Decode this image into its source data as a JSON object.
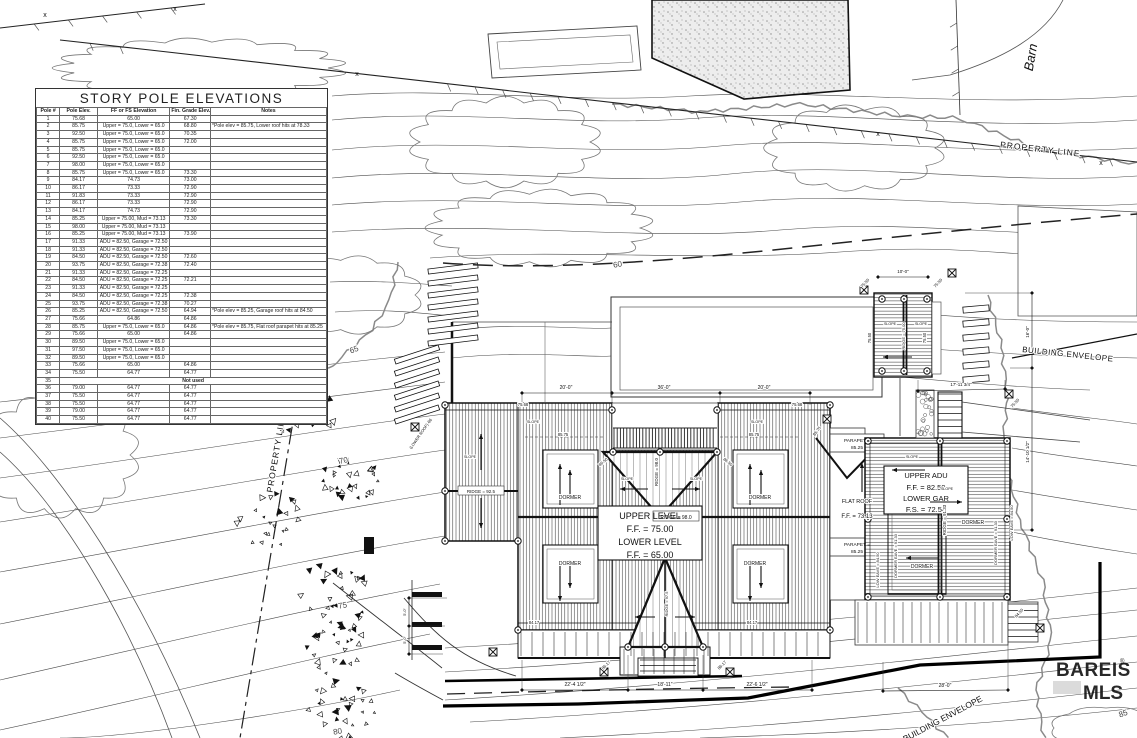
{
  "story_pole_table": {
    "title": "STORY POLE ELEVATIONS",
    "headers": [
      "Pole #",
      "Pole Elev.",
      "FF or FS Elevation",
      "Fin. Grade Elev.",
      "Notes"
    ],
    "rows": [
      [
        "1",
        "75.68",
        "65.00",
        "67.30",
        ""
      ],
      [
        "2",
        "85.75",
        "Upper = 75.0, Lower = 65.0",
        "68.80",
        "*Pole elev = 85.75, Lower roof hits at 78.33"
      ],
      [
        "3",
        "92.50",
        "Upper = 75.0, Lower = 65.0",
        "70.35",
        ""
      ],
      [
        "4",
        "85.75",
        "Upper = 75.0, Lower = 65.0",
        "72.00",
        ""
      ],
      [
        "5",
        "85.75",
        "Upper = 75.0, Lower = 65.0",
        "",
        ""
      ],
      [
        "6",
        "92.50",
        "Upper = 75.0, Lower = 65.0",
        "",
        ""
      ],
      [
        "7",
        "98.00",
        "Upper = 75.0, Lower = 65.0",
        "",
        ""
      ],
      [
        "8",
        "85.75",
        "Upper = 75.0, Lower = 65.0",
        "73.30",
        ""
      ],
      [
        "9",
        "84.17",
        "74.73",
        "73.00",
        ""
      ],
      [
        "10",
        "86.17",
        "73.33",
        "72.90",
        ""
      ],
      [
        "11",
        "91.83",
        "73.33",
        "72.90",
        ""
      ],
      [
        "12",
        "86.17",
        "73.33",
        "72.90",
        ""
      ],
      [
        "13",
        "84.17",
        "74.73",
        "72.90",
        ""
      ],
      [
        "14",
        "85.25",
        "Upper = 75.00, Mud = 73.13",
        "73.30",
        ""
      ],
      [
        "15",
        "98.00",
        "Upper = 75.00, Mud = 73.13",
        "",
        ""
      ],
      [
        "16",
        "85.25",
        "Upper = 75.00, Mud = 73.13",
        "73.90",
        ""
      ],
      [
        "17",
        "91.33",
        "ADU = 82.50, Garage = 72.50",
        "",
        ""
      ],
      [
        "18",
        "91.33",
        "ADU = 82.50, Garage = 72.50",
        "",
        ""
      ],
      [
        "19",
        "84.50",
        "ADU = 82.50, Garage = 72.50",
        "72.60",
        ""
      ],
      [
        "20",
        "93.75",
        "ADU = 82.50, Garage = 72.38",
        "72.40",
        ""
      ],
      [
        "21",
        "91.33",
        "ADU = 82.50, Garage = 72.25",
        "",
        ""
      ],
      [
        "22",
        "84.50",
        "ADU = 82.50, Garage = 72.25",
        "72.21",
        ""
      ],
      [
        "23",
        "91.33",
        "ADU = 82.50, Garage = 72.25",
        "",
        ""
      ],
      [
        "24",
        "84.50",
        "ADU = 82.50, Garage = 72.25",
        "72.38",
        ""
      ],
      [
        "25",
        "93.75",
        "ADU = 82.50, Garage = 72.38",
        "70.27",
        ""
      ],
      [
        "26",
        "85.25",
        "ADU = 82.50, Garage = 72.50",
        "64.94",
        "*Pole elev = 85.25, Garage roof hits at 84.50"
      ],
      [
        "27",
        "75.66",
        "64.86",
        "64.86",
        ""
      ],
      [
        "28",
        "85.75",
        "Upper = 75.0, Lower = 65.0",
        "64.86",
        "*Pole elev = 85.75, Flat roof parapet hits at 85.25"
      ],
      [
        "29",
        "75.66",
        "65.00",
        "64.86",
        ""
      ],
      [
        "30",
        "89.50",
        "Upper = 75.0, Lower = 65.0",
        "",
        ""
      ],
      [
        "31",
        "97.50",
        "Upper = 75.0, Lower = 65.0",
        "",
        ""
      ],
      [
        "32",
        "89.50",
        "Upper = 75.0, Lower = 65.0",
        "",
        ""
      ],
      [
        "33",
        "75.66",
        "65.00",
        "64.86",
        ""
      ],
      [
        "34",
        "75.50",
        "64.77",
        "64.77",
        ""
      ],
      [
        "35",
        "Not used"
      ],
      [
        "36",
        "79.00",
        "64.77",
        "64.77",
        ""
      ],
      [
        "37",
        "75.50",
        "64.77",
        "64.77",
        ""
      ],
      [
        "38",
        "75.50",
        "64.77",
        "64.77",
        ""
      ],
      [
        "39",
        "79.00",
        "64.77",
        "64.77",
        ""
      ],
      [
        "40",
        "75.50",
        "64.77",
        "64.77",
        ""
      ]
    ]
  },
  "labels": {
    "barn": "Barn",
    "property_line_top": "PROPERTY LINE",
    "property_line_left": "PROPERTY LINE",
    "building_envelope_right": "BUILDING ENVELOPE",
    "building_envelope_bottom": "BUILDING ENVELOPE",
    "contour_60": "60",
    "contour_65": "65",
    "contour_70": "70",
    "contour_75": "75",
    "contour_80": "80",
    "contour_85": "85",
    "upper_level": "UPPER LEVEL",
    "upper_level_ff": "F.F. = 75.00",
    "lower_level": "LOWER LEVEL",
    "lower_level_ff": "F.F. = 65.00",
    "upper_adu": "UPPER ADU",
    "upper_adu_ff": "F.F. = 82.50",
    "lower_gar": "LOWER GAR",
    "lower_gar_fs": "F.S. = 72.50",
    "flat_roof": "FLAT ROOF",
    "flat_roof_ff": "F.F. = 73.13",
    "parapet_line1": "PARAPET =",
    "parapet_line2": "85.25",
    "ridge_main": "RIDGE = 98.0",
    "ridge_left_wing": "RIDGE = 92.5",
    "ridge_lower_gable": "RIDGE = 97.5",
    "ridge_adu": "RIDGE = 91.33",
    "ridge_carport": "RIDGE = 75.00",
    "low_eave_right": "LOW EAVE = 84.50",
    "dormer_eave_right": "DORMER EAVE = 91.33",
    "low_eave_left": "LOW EAVE = 84.50",
    "dormer_eave_left": "DORMER EAVE = 91.33",
    "dormer": "DORMER",
    "slope": "SLOPE",
    "lower_roof": "(LOWER ROOF)",
    "dim_20a": "20'-0\"",
    "dim_36": "36'-0\"",
    "dim_20b": "20'-0\"",
    "dim_10": "10'-0\"",
    "dim_16": "16'-0\"",
    "dim_14": "14'-10 1/2\"",
    "dim_17": "17'-11 3/4\"",
    "dim_22a": "22'-4 1/2\"",
    "dim_18": "18'-11\"",
    "dim_22b": "22'-6 1/2\"",
    "dim_28": "28'-0\"",
    "dim_5": "5'-0\"",
    "x_mark": "x"
  },
  "pole_marks": [
    "75.68",
    "75.68",
    "85.75",
    "85.75",
    "85.75",
    "75.66",
    "86.17",
    "86.17",
    "84.17",
    "84.17",
    "75.50",
    "75.50",
    "75.50",
    "84.50",
    "86.50",
    "86.50",
    "75.50",
    "75.50"
  ],
  "watermark": {
    "line1": "BAREIS",
    "reg": "®",
    "line2": "MLS"
  },
  "colors": {
    "ink": "#111111",
    "contour": "#4a4a4a",
    "fence_trace": "#8a8a8a",
    "watermark": "#c9c9c9"
  }
}
